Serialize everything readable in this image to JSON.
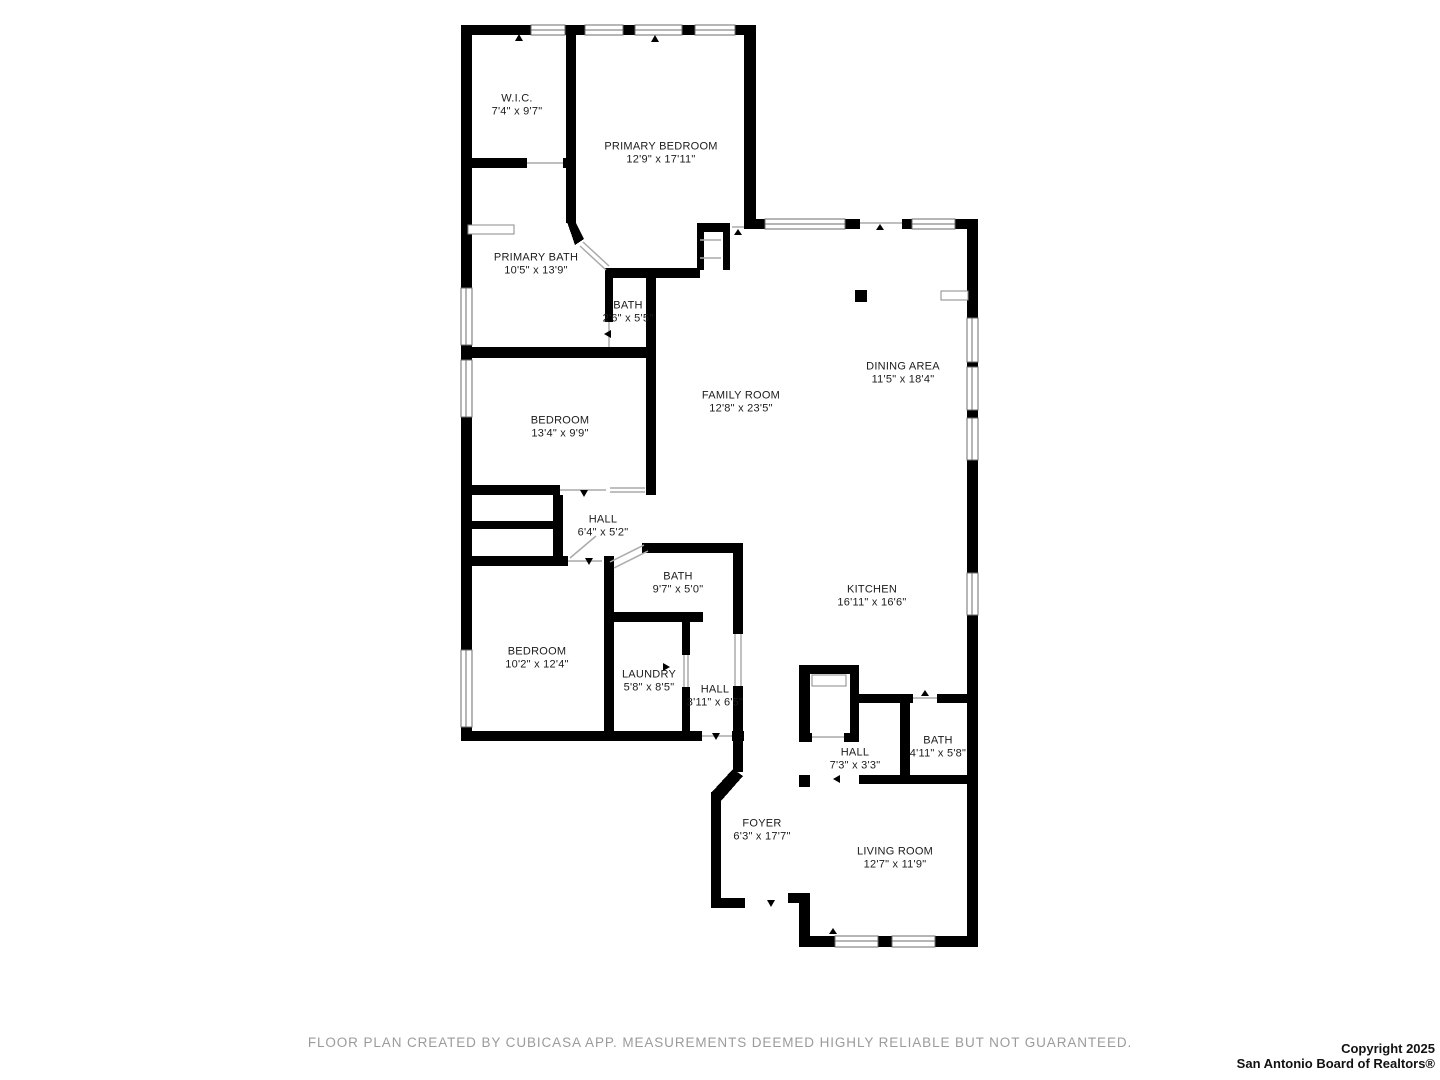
{
  "rooms": [
    {
      "name": "W.I.C.",
      "dims": "7'4\" x 9'7\""
    },
    {
      "name": "PRIMARY BEDROOM",
      "dims": "12'9\" x 17'11\""
    },
    {
      "name": "PRIMARY BATH",
      "dims": "10'5\" x 13'9\""
    },
    {
      "name": "BATH",
      "dims": "2'6\" x 5'5\""
    },
    {
      "name": "DINING AREA",
      "dims": "11'5\" x 18'4\""
    },
    {
      "name": "FAMILY ROOM",
      "dims": "12'8\" x 23'5\""
    },
    {
      "name": "BEDROOM",
      "dims": "13'4\" x 9'9\""
    },
    {
      "name": "HALL",
      "dims": "6'4\" x 5'2\""
    },
    {
      "name": "BATH",
      "dims": "9'7\" x 5'0\""
    },
    {
      "name": "KITCHEN",
      "dims": "16'11\" x 16'6\""
    },
    {
      "name": "BEDROOM",
      "dims": "10'2\" x 12'4\""
    },
    {
      "name": "LAUNDRY",
      "dims": "5'8\" x 8'5\""
    },
    {
      "name": "HALL",
      "dims": "3'11\" x 6'5\""
    },
    {
      "name": "HALL",
      "dims": "7'3\" x 3'3\""
    },
    {
      "name": "BATH",
      "dims": "4'11\" x 5'8\""
    },
    {
      "name": "FOYER",
      "dims": "6'3\" x 17'7\""
    },
    {
      "name": "LIVING ROOM",
      "dims": "12'7\" x 11'9\""
    }
  ],
  "footer": {
    "disclaimer": "FLOOR PLAN CREATED BY CUBICASA APP. MEASUREMENTS DEEMED HIGHLY RELIABLE BUT NOT GUARANTEED."
  },
  "copyright": {
    "line1": "Copyright 2025",
    "line2": "San Antonio Board of Realtors®"
  },
  "colors": {
    "wall": "#000000",
    "window_frame": "#6e6e6e",
    "opening_line": "#aaaaaa",
    "disclaimer_text": "#9b9b9b"
  }
}
